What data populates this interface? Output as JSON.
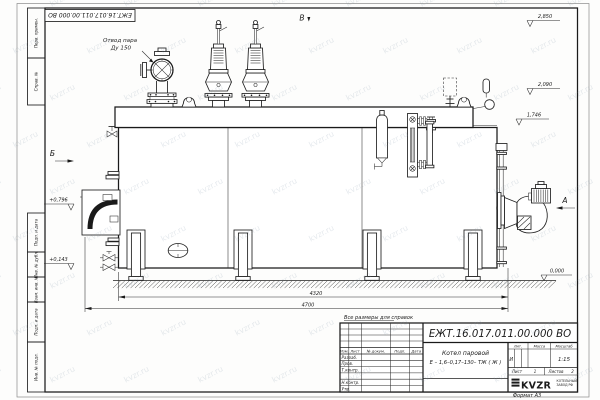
{
  "watermark": {
    "text": "kvzr.ru"
  },
  "corner_stamp": {
    "doc_number": "ЕЖТ.16.017.011.00.000 ВО"
  },
  "margin_blocks": [
    {
      "label": "Перв. примен."
    },
    {
      "label": "Справ. №"
    },
    {
      "label": "Подп. и дата"
    },
    {
      "label": "Инв. № дубл."
    },
    {
      "label": "Взам. инв. №"
    },
    {
      "label": "Подп. и дата"
    },
    {
      "label": "Инв. № подл."
    }
  ],
  "drawing": {
    "callout": {
      "line1": "Отвод пара",
      "line2": "Ду 150"
    },
    "view_markers": {
      "a": "А",
      "b": "Б",
      "v": "В"
    },
    "elevations": {
      "top": "2,850",
      "mid": "2,090",
      "drum": "1,746",
      "front_axis": "+0,796",
      "front_low": "+0,143",
      "ground": "0,000"
    },
    "dimensions": {
      "inner": "4320",
      "overall": "4700"
    },
    "note": "Все размеры для справок"
  },
  "title_block": {
    "doc_number": "ЕЖТ.16.017.011.00.000 ВО",
    "product_line1": "Котел паровой",
    "product_line2": "Е – 1,6–0,17–130– ТЖ ( Ж )",
    "cols": {
      "izm": "Изм.",
      "list": "Лист",
      "doc": "№ докум.",
      "sign": "Подп.",
      "date": "Дата"
    },
    "rows": [
      "Разраб.",
      "Пров.",
      "Т.контр.",
      "",
      "Н.контр.",
      "Утв."
    ],
    "lit_label": "Лит.",
    "mass_label": "Масса",
    "scale_label": "Масштаб",
    "lit_value": "И",
    "scale_value": "1:15",
    "sheet_label": "Лист",
    "sheet_value": "1",
    "sheets_label": "Листов",
    "sheets_value": "2",
    "company": {
      "logo": "KVZR",
      "name_line1": "КОТЕЛЬНЫЙ",
      "name_line2": "ЗАВОД РФ"
    },
    "format_label": "Формат А3"
  }
}
